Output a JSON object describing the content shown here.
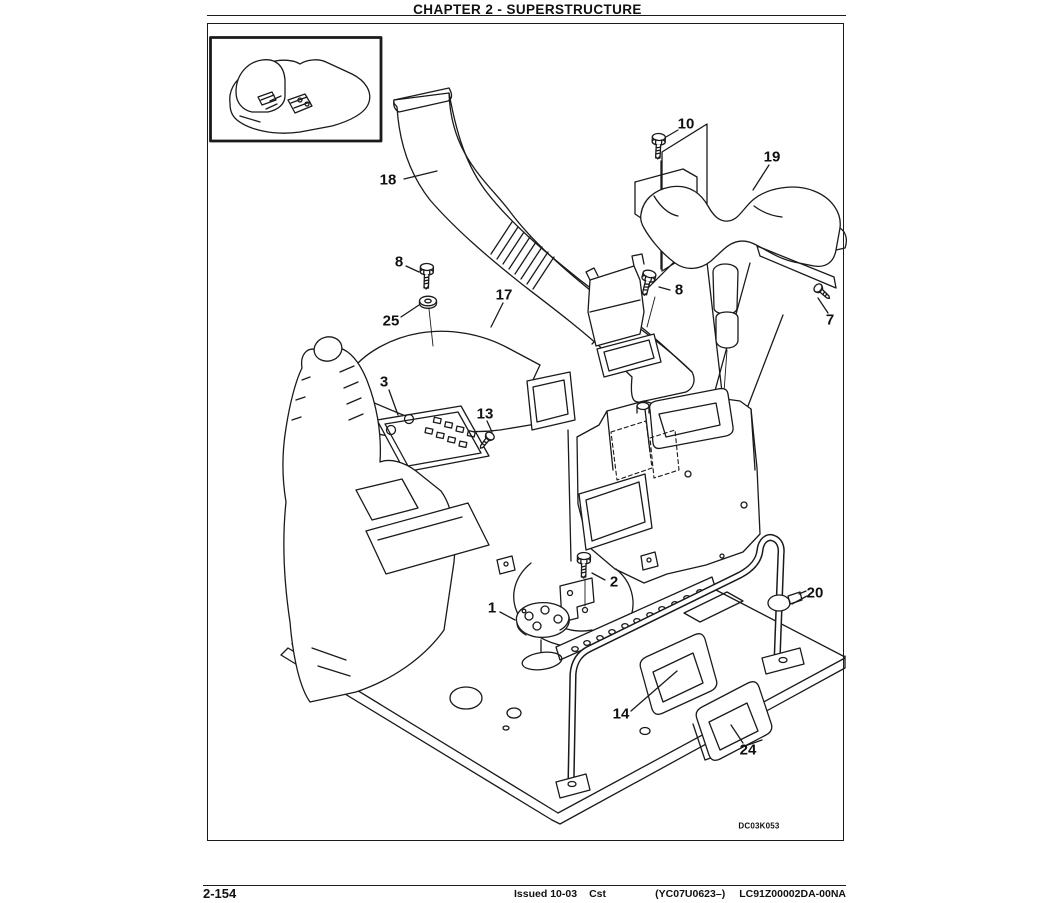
{
  "header": {
    "title": "CHAPTER 2 - SUPERSTRUCTURE"
  },
  "figure": {
    "code": "DC03K053",
    "callouts": [
      {
        "label": "18"
      },
      {
        "label": "10"
      },
      {
        "label": "19"
      },
      {
        "label": "8"
      },
      {
        "label": "25"
      },
      {
        "label": "17"
      },
      {
        "label": "8"
      },
      {
        "label": "7"
      },
      {
        "label": "3"
      },
      {
        "label": "13"
      },
      {
        "label": "2"
      },
      {
        "label": "1"
      },
      {
        "label": "20"
      },
      {
        "label": "14"
      },
      {
        "label": "24"
      }
    ]
  },
  "footer": {
    "page_number": "2-154",
    "issued": "Issued 10-03",
    "cst": "Cst",
    "serial_range": "(YC07U0623–)",
    "form_number": "LC91Z00002DA-00NA"
  }
}
